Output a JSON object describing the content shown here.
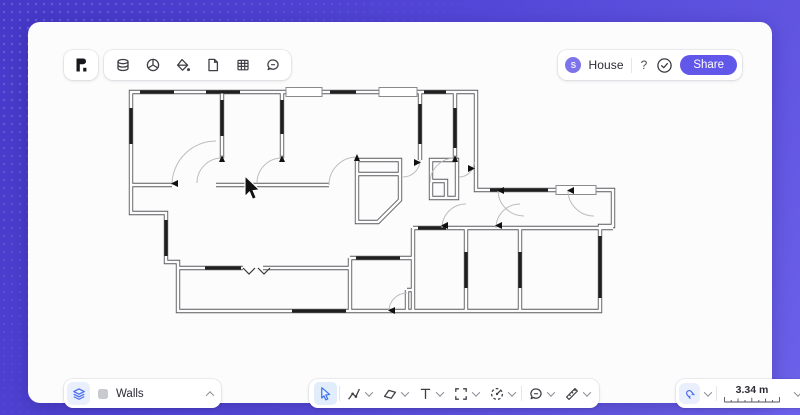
{
  "app": {
    "name": "rayon-floor-plan-editor"
  },
  "top_toolbar": {
    "logo_icon": "rayon-logo",
    "icons": [
      "layers-icon",
      "solids-icon",
      "paint-bucket-icon",
      "page-icon",
      "table-icon",
      "chat-icon"
    ]
  },
  "header": {
    "avatar_initial": "S",
    "doc_title": "House",
    "help_label": "?",
    "sync_icon": "check-circle-icon",
    "share_label": "Share"
  },
  "layers_panel": {
    "panel_icon": "walls-layer-icon",
    "swatch": "layer-color-swatch",
    "active_layer": "Walls"
  },
  "tools_toolbar": {
    "selected_tool": "select",
    "tools": [
      "select-cursor",
      "draw-path",
      "shape",
      "text",
      "frame",
      "component",
      "comment",
      "measure"
    ]
  },
  "scale_panel": {
    "snap_icon": "snap-magnet-icon",
    "scale_value": "3.34 m",
    "scale_ruler": "scale-ruler"
  },
  "canvas": {
    "content": "house-floor-plan-drawing"
  },
  "colors": {
    "frame_gradient_start": "#4638c8",
    "frame_gradient_end": "#6c61e9",
    "accent_purple": "#6157e8",
    "tool_blue": "#4a6cf0",
    "selected_tool_bg": "#e2edfb",
    "canvas_bg": "#fcfcfc",
    "wall_line": "#555555",
    "window_bar": "#1f1f1f"
  }
}
